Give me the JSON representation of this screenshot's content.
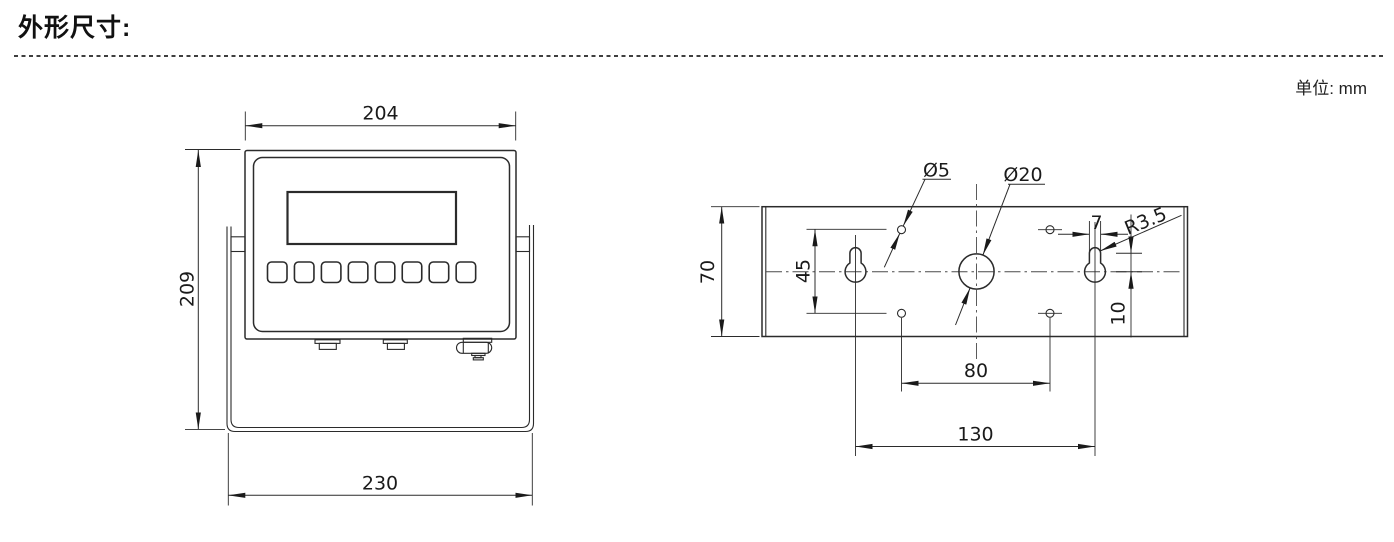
{
  "header": {
    "title": "外形尺寸:",
    "units": "单位: mm"
  },
  "front_view": {
    "description": "weighing indicator front view with display, 8 keypad buttons and mounting bracket",
    "button_count": 8,
    "dims": {
      "top_width": "204",
      "height": "209",
      "bottom_width": "230"
    }
  },
  "rear_view": {
    "description": "rear mounting plate with keyhole slots and holes",
    "dims": {
      "plate_height": "70",
      "small_hole_vertical_span": "45",
      "small_hole_dia": "Ø5",
      "large_hole_dia": "Ø20",
      "slot_width": "7",
      "slot_radius": "R3.5",
      "slot_center_offset": "10",
      "small_hole_spacing": "80",
      "keyhole_spacing": "130"
    }
  }
}
